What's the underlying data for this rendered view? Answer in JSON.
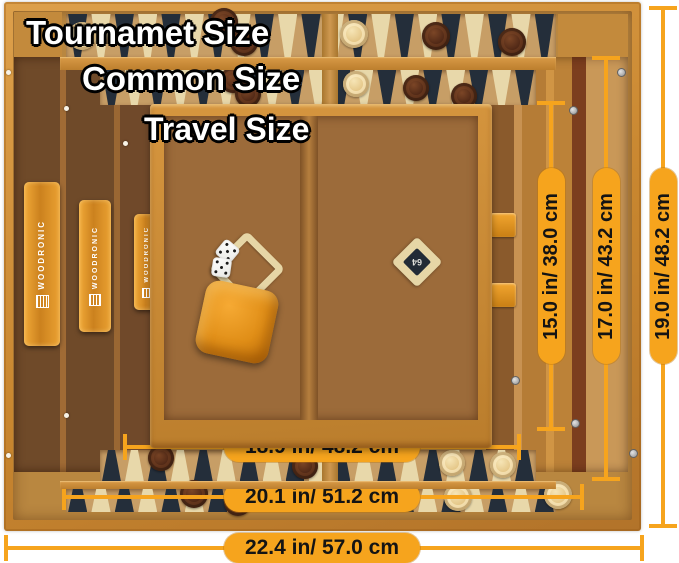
{
  "image": {
    "width": 679,
    "height": 563,
    "background": "#FFFFFF"
  },
  "brand": {
    "name": "WOODRONIC"
  },
  "doubling_cube": {
    "value": "64"
  },
  "size_labels": [
    {
      "text": "Tournamet Size",
      "x": 26,
      "y": 16,
      "font_size": 33
    },
    {
      "text": "Common Size",
      "x": 82,
      "y": 62,
      "font_size": 33
    },
    {
      "text": "Travel Size",
      "x": 144,
      "y": 113,
      "font_size": 32
    }
  ],
  "dimensions": {
    "vertical": [
      {
        "label": "15.0 in/ 38.0 cm",
        "x": 551,
        "y1": 101,
        "y2": 431,
        "pill_cy": 266,
        "pill_len": 196
      },
      {
        "label": "17.0 in/ 43.2 cm",
        "x": 606,
        "y1": 56,
        "y2": 481,
        "pill_cy": 266,
        "pill_len": 196
      },
      {
        "label": "19.0 in/ 48.2 cm",
        "x": 663,
        "y1": 6,
        "y2": 528,
        "pill_cy": 266,
        "pill_len": 196
      }
    ],
    "horizontal": [
      {
        "label": "18.9 in/ 48.2 cm",
        "y": 447,
        "x1": 123,
        "x2": 521,
        "pill_cx": 322,
        "pill_len": 196
      },
      {
        "label": "20.1 in/ 51.2 cm",
        "y": 497,
        "x1": 62,
        "x2": 584,
        "pill_cx": 322,
        "pill_len": 196
      },
      {
        "label": "22.4 in/ 57.0 cm",
        "y": 548,
        "x1": 4,
        "x2": 644,
        "pill_cx": 322,
        "pill_len": 196
      }
    ]
  },
  "colors": {
    "accent": "#F6A41D",
    "pill_text": "#141414",
    "label_text": "#FFFFFF",
    "label_outline": "#000000",
    "wood_frame": "#D0903C",
    "wood_field": "#9C6B3A",
    "point_dark": "#242E3A",
    "point_cream": "#E8D8AA",
    "checker_dark": "#4A2414",
    "checker_cream": "#EFD9A4",
    "cube_orange": "#E8901C",
    "brass": "#BD9A4C"
  },
  "scene": {
    "bands": [
      {
        "name": "tournament-top-points",
        "x": 66,
        "y": 14,
        "w": 490,
        "h": 43,
        "tri": 64,
        "dir": "down",
        "count": 21
      },
      {
        "name": "common-top-points",
        "x": 100,
        "y": 70,
        "w": 436,
        "h": 35,
        "tri": 54,
        "dir": "down",
        "count": 19
      },
      {
        "name": "common-bottom-points",
        "x": 100,
        "y": 450,
        "w": 436,
        "h": 31,
        "tri": 50,
        "dir": "up",
        "count": 19
      },
      {
        "name": "tournament-bottom-points",
        "x": 66,
        "y": 489,
        "w": 490,
        "h": 23,
        "tri": 46,
        "dir": "up",
        "count": 21
      }
    ],
    "band_dividers": [
      {
        "x": 322,
        "y": 14,
        "w": 16,
        "h": 43
      },
      {
        "x": 322,
        "y": 70,
        "w": 16,
        "h": 35
      },
      {
        "x": 322,
        "y": 450,
        "w": 16,
        "h": 31
      },
      {
        "x": 322,
        "y": 489,
        "w": 16,
        "h": 23
      }
    ],
    "travel_rows": [
      {
        "x": 166,
        "y": 116,
        "w": 132,
        "h": 104,
        "count": 6,
        "dir": "down",
        "start": "dark"
      },
      {
        "x": 320,
        "y": 116,
        "w": 156,
        "h": 104,
        "count": 6,
        "dir": "down",
        "start": "dark"
      },
      {
        "x": 166,
        "y": 318,
        "w": 132,
        "h": 102,
        "count": 6,
        "dir": "up",
        "start": "cream"
      },
      {
        "x": 320,
        "y": 318,
        "w": 156,
        "h": 102,
        "count": 6,
        "dir": "up",
        "start": "cream"
      }
    ],
    "spines": [
      {
        "x": 24,
        "y": 182,
        "w": 36,
        "h": 164,
        "font": 8,
        "logo": 11
      },
      {
        "x": 79,
        "y": 200,
        "w": 32,
        "h": 132,
        "font": 7,
        "logo": 10
      },
      {
        "x": 134,
        "y": 214,
        "w": 26,
        "h": 96,
        "font": 6,
        "logo": 8
      }
    ],
    "latches": [
      {
        "x": 490,
        "y": 213
      },
      {
        "x": 490,
        "y": 283
      }
    ],
    "hinges": [
      {
        "x": 309,
        "y": 136,
        "w": 16,
        "h": 52
      },
      {
        "x": 309,
        "y": 336,
        "w": 16,
        "h": 54
      }
    ],
    "checkers": [
      {
        "x": 82,
        "y": 36,
        "c": "c",
        "s": 28
      },
      {
        "x": 224,
        "y": 22,
        "c": "d",
        "s": 28
      },
      {
        "x": 244,
        "y": 42,
        "c": "d",
        "s": 28
      },
      {
        "x": 354,
        "y": 34,
        "c": "c",
        "s": 28
      },
      {
        "x": 436,
        "y": 36,
        "c": "d",
        "s": 28
      },
      {
        "x": 512,
        "y": 42,
        "c": "d",
        "s": 28
      },
      {
        "x": 233,
        "y": 80,
        "c": "d",
        "s": 26
      },
      {
        "x": 248,
        "y": 94,
        "c": "d",
        "s": 26
      },
      {
        "x": 356,
        "y": 84,
        "c": "c",
        "s": 26
      },
      {
        "x": 416,
        "y": 88,
        "c": "d",
        "s": 26
      },
      {
        "x": 464,
        "y": 96,
        "c": "d",
        "s": 26
      },
      {
        "x": 173,
        "y": 120,
        "c": "c",
        "s": 26
      },
      {
        "x": 175,
        "y": 144,
        "c": "c",
        "s": 26
      },
      {
        "x": 178,
        "y": 168,
        "c": "c",
        "s": 26
      },
      {
        "x": 252,
        "y": 224,
        "c": "d",
        "s": 26
      },
      {
        "x": 274,
        "y": 238,
        "c": "d",
        "s": 26
      },
      {
        "x": 260,
        "y": 251,
        "c": "d",
        "s": 26
      },
      {
        "x": 343,
        "y": 123,
        "c": "c",
        "s": 26
      },
      {
        "x": 343,
        "y": 147,
        "c": "c",
        "s": 26
      },
      {
        "x": 343,
        "y": 170,
        "c": "c",
        "s": 26
      },
      {
        "x": 392,
        "y": 121,
        "c": "d",
        "s": 26
      },
      {
        "x": 441,
        "y": 118,
        "c": "d",
        "s": 26
      },
      {
        "x": 441,
        "y": 141,
        "c": "d",
        "s": 26
      },
      {
        "x": 197,
        "y": 358,
        "c": "d",
        "s": 26
      },
      {
        "x": 197,
        "y": 382,
        "c": "d",
        "s": 26
      },
      {
        "x": 197,
        "y": 406,
        "c": "d",
        "s": 26
      },
      {
        "x": 288,
        "y": 330,
        "c": "c",
        "s": 26
      },
      {
        "x": 288,
        "y": 354,
        "c": "c",
        "s": 26
      },
      {
        "x": 288,
        "y": 378,
        "c": "c",
        "s": 26
      },
      {
        "x": 288,
        "y": 402,
        "c": "c",
        "s": 26
      },
      {
        "x": 370,
        "y": 310,
        "c": "c",
        "s": 26
      },
      {
        "x": 370,
        "y": 334,
        "c": "c",
        "s": 26
      },
      {
        "x": 370,
        "y": 358,
        "c": "c",
        "s": 26
      },
      {
        "x": 370,
        "y": 382,
        "c": "c",
        "s": 26
      },
      {
        "x": 370,
        "y": 406,
        "c": "c",
        "s": 26
      },
      {
        "x": 342,
        "y": 356,
        "c": "d",
        "s": 26
      },
      {
        "x": 342,
        "y": 380,
        "c": "d",
        "s": 26
      },
      {
        "x": 342,
        "y": 404,
        "c": "d",
        "s": 26
      },
      {
        "x": 418,
        "y": 360,
        "c": "c",
        "s": 26
      },
      {
        "x": 418,
        "y": 384,
        "c": "c",
        "s": 26
      },
      {
        "x": 468,
        "y": 383,
        "c": "c",
        "s": 26
      },
      {
        "x": 468,
        "y": 407,
        "c": "c",
        "s": 26
      },
      {
        "x": 161,
        "y": 458,
        "c": "d",
        "s": 26
      },
      {
        "x": 305,
        "y": 466,
        "c": "d",
        "s": 26
      },
      {
        "x": 452,
        "y": 463,
        "c": "c",
        "s": 26
      },
      {
        "x": 503,
        "y": 465,
        "c": "c",
        "s": 26
      },
      {
        "x": 194,
        "y": 494,
        "c": "d",
        "s": 28
      },
      {
        "x": 238,
        "y": 502,
        "c": "d",
        "s": 28
      },
      {
        "x": 458,
        "y": 497,
        "c": "c",
        "s": 28
      },
      {
        "x": 558,
        "y": 495,
        "c": "c",
        "s": 28
      }
    ],
    "dots": [
      {
        "x": 6,
        "y": 70,
        "t": "w"
      },
      {
        "x": 64,
        "y": 106,
        "t": "w"
      },
      {
        "x": 123,
        "y": 141,
        "t": "w"
      },
      {
        "x": 6,
        "y": 453,
        "t": "w"
      },
      {
        "x": 64,
        "y": 413,
        "t": "w"
      },
      {
        "x": 203,
        "y": 421,
        "t": "w"
      },
      {
        "x": 617,
        "y": 68,
        "t": "s"
      },
      {
        "x": 569,
        "y": 106,
        "t": "s"
      },
      {
        "x": 571,
        "y": 419,
        "t": "s"
      },
      {
        "x": 629,
        "y": 449,
        "t": "s"
      },
      {
        "x": 511,
        "y": 376,
        "t": "s"
      }
    ]
  }
}
